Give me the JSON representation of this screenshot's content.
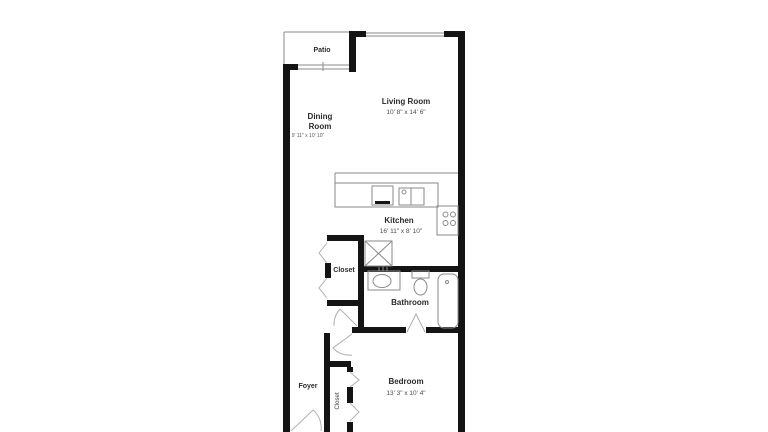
{
  "floor_plan": {
    "background_color": "#ffffff",
    "wall_color": "#141414",
    "fixture_line_color": "#8a8a8a",
    "text_color": "#2b2b2b",
    "rooms": {
      "patio": {
        "label": "Patio"
      },
      "living_room": {
        "label": "Living Room",
        "dimensions": "10' 8\" x 14' 6\""
      },
      "dining_room": {
        "label_line1": "Dining",
        "label_line2": "Room",
        "dimensions": "9' 11\" x 10' 10\""
      },
      "kitchen": {
        "label": "Kitchen",
        "dimensions": "16' 11\" x 8' 10\""
      },
      "hall_closet": {
        "label": "Closet"
      },
      "bathroom": {
        "label": "Bathroom"
      },
      "foyer": {
        "label": "Foyer"
      },
      "bedroom": {
        "label": "Bedroom",
        "dimensions": "13' 3\" x 10' 4\""
      },
      "bedroom_closet": {
        "label": "Closet"
      }
    },
    "fixtures": [
      "patio-sliding-door",
      "living-room-window",
      "kitchen-bar-counter",
      "dishwasher",
      "kitchen-sink",
      "stove-4-burner",
      "washer-dryer",
      "bathroom-vanity-sink",
      "toilet",
      "bathtub",
      "bifold-closet-doors",
      "swing-doors",
      "entry-door"
    ]
  }
}
